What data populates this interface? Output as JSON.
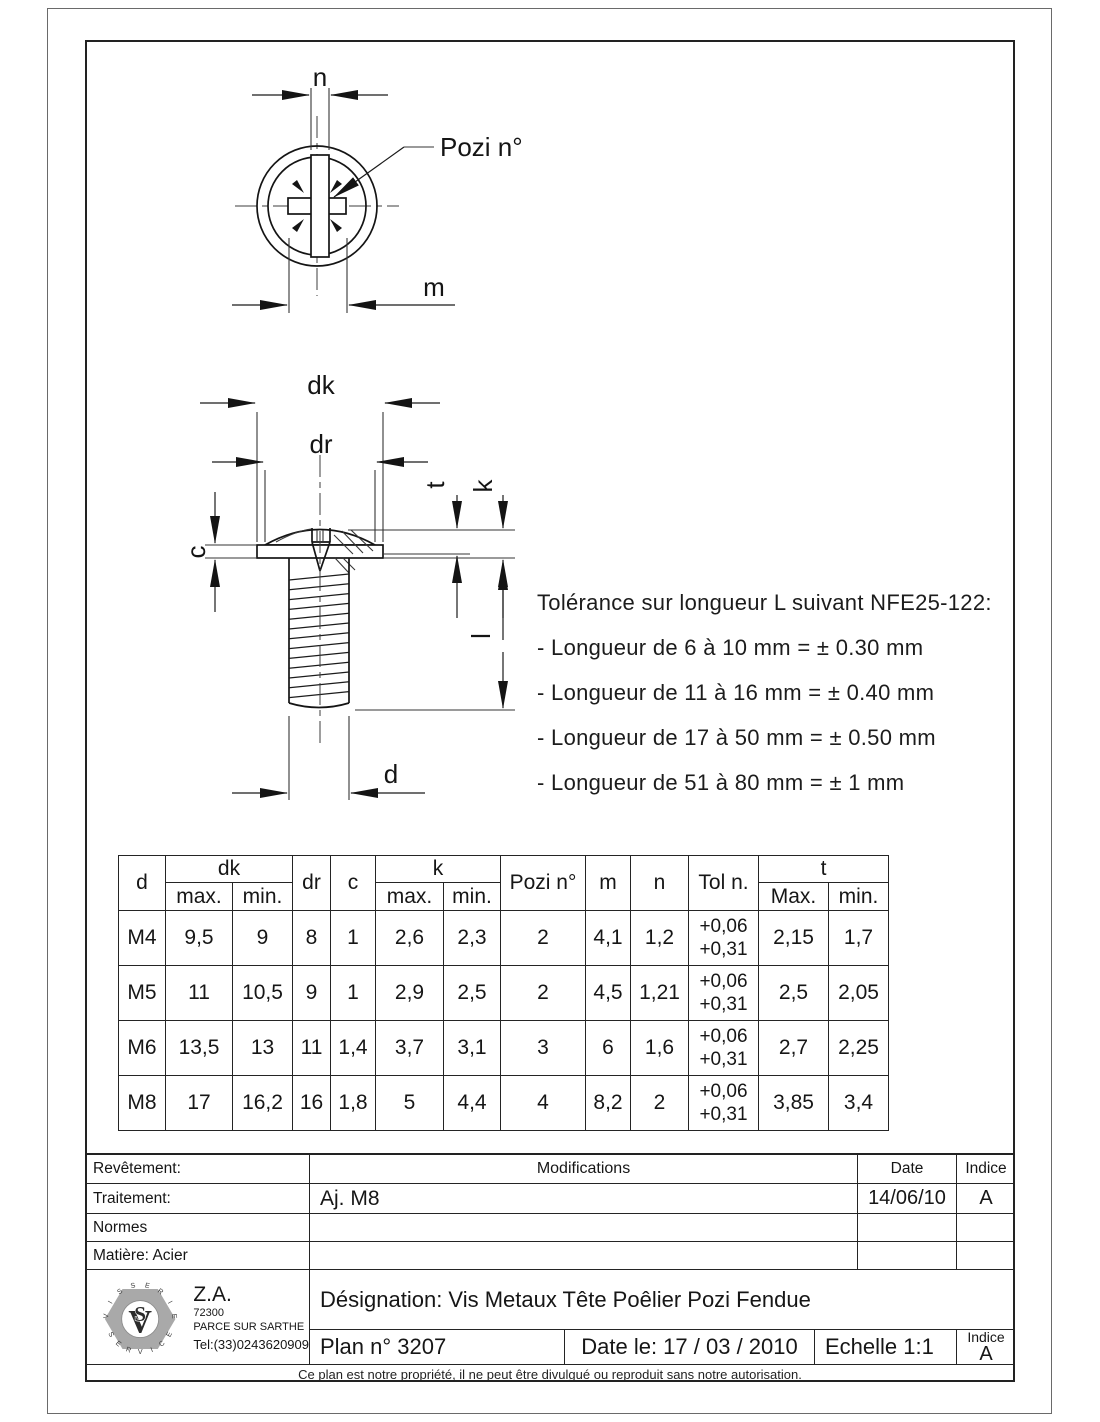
{
  "drawing": {
    "labels": {
      "n": "n",
      "m": "m",
      "pozi_callout": "Pozi n°",
      "dk": "dk",
      "dr": "dr",
      "c": "c",
      "t": "t",
      "k": "k",
      "l": "l",
      "d": "d"
    },
    "tolerance_note": {
      "title": "Tolérance sur longueur L suivant NFE25-122:",
      "lines": [
        "- Longueur de 6 à 10 mm = ± 0.30 mm",
        "- Longueur de 11 à 16 mm = ± 0.40 mm",
        "- Longueur de 17 à 50 mm = ± 0.50 mm",
        "- Longueur de 51 à 80 mm = ± 1 mm"
      ]
    }
  },
  "dimension_table": {
    "headers": {
      "d": "d",
      "dk": "dk",
      "max": "max.",
      "min": "min.",
      "dr": "dr",
      "c": "c",
      "k": "k",
      "pozi": "Pozi n°",
      "m": "m",
      "n": "n",
      "tol": "Tol n.",
      "t": "t",
      "tmax": "Max.",
      "tmin": "min."
    },
    "rows": [
      {
        "d": "M4",
        "dk_max": "9,5",
        "dk_min": "9",
        "dr": "8",
        "c": "1",
        "k_max": "2,6",
        "k_min": "2,3",
        "pozi": "2",
        "m": "4,1",
        "n": "1,2",
        "tol": [
          "+0,06",
          "+0,31"
        ],
        "t_max": "2,15",
        "t_min": "1,7"
      },
      {
        "d": "M5",
        "dk_max": "11",
        "dk_min": "10,5",
        "dr": "9",
        "c": "1",
        "k_max": "2,9",
        "k_min": "2,5",
        "pozi": "2",
        "m": "4,5",
        "n": "1,21",
        "tol": [
          "+0,06",
          "+0,31"
        ],
        "t_max": "2,5",
        "t_min": "2,05"
      },
      {
        "d": "M6",
        "dk_max": "13,5",
        "dk_min": "13",
        "dr": "11",
        "c": "1,4",
        "k_max": "3,7",
        "k_min": "3,1",
        "pozi": "3",
        "m": "6",
        "n": "1,6",
        "tol": [
          "+0,06",
          "+0,31"
        ],
        "t_max": "2,7",
        "t_min": "2,25"
      },
      {
        "d": "M8",
        "dk_max": "17",
        "dk_min": "16,2",
        "dr": "16",
        "c": "1,8",
        "k_max": "5",
        "k_min": "4,4",
        "pozi": "4",
        "m": "8,2",
        "n": "2",
        "tol": [
          "+0,06",
          "+0,31"
        ],
        "t_max": "3,85",
        "t_min": "3,4"
      }
    ]
  },
  "title_block": {
    "revetement": "Revêtement:",
    "traitement": "Traitement:",
    "normes": "Normes",
    "matiere": "Matière: Acier",
    "modifications_header": "Modifications",
    "date_header": "Date",
    "indice_header": "Indice",
    "mod_rows": [
      {
        "mod": "Aj. M8",
        "date": "14/06/10",
        "indice": "A"
      },
      {
        "mod": "",
        "date": "",
        "indice": ""
      },
      {
        "mod": "",
        "date": "",
        "indice": ""
      }
    ],
    "designation": "Désignation:  Vis Metaux Tête Poêlier Pozi Fendue",
    "plan": "Plan n° 3207",
    "date_le": "Date le: 17 / 03 / 2010",
    "echelle": "Echelle 1:1",
    "indice_label": "Indice",
    "indice_value": "A",
    "footer": "Ce plan est notre propriété, il ne peut être divulgué ou reproduit sans notre autorisation."
  },
  "logo": {
    "ring_top": "VISSERIE",
    "ring_bottom": "SERVICE",
    "monogram_v": "V",
    "monogram_s": "S",
    "address1": "Z.A.",
    "address2": "72300",
    "address3": "PARCE SUR SARTHE",
    "address4": "Tel:(33)0243620909"
  }
}
